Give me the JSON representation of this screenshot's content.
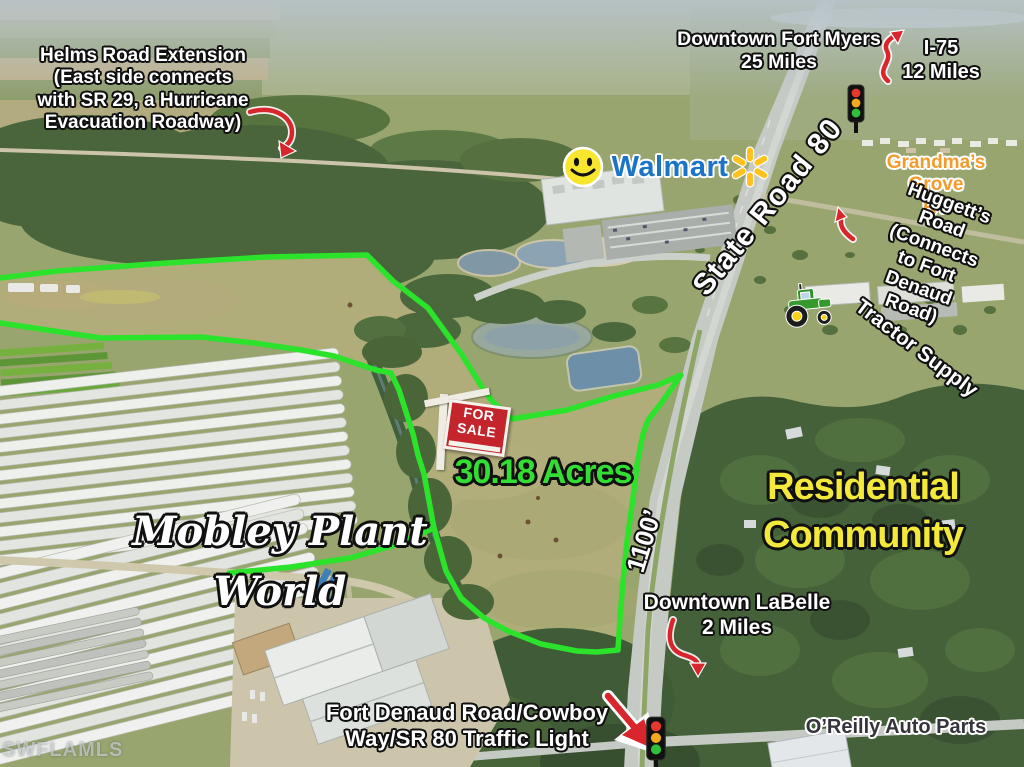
{
  "meta": {
    "type": "aerial-real-estate-listing-photo",
    "watermark": "SWFLAMLS"
  },
  "property": {
    "acreage": "30.18 Acres",
    "road_frontage": "1100’",
    "for_sale_sign": "FOR\nSALE",
    "boundary_color": "#2be32b"
  },
  "annotations": {
    "helms_road": "Helms Road Extension\n(East side connects\nwith SR 29, a Hurricane\nEvacuation Roadway)",
    "downtown_fort_myers": "Downtown Fort Myers\n25 Miles",
    "i75": "I-75\n12 Miles",
    "walmart": "Walmart",
    "state_road_80": "State Road 80",
    "grandmas_grove_rv": "Grandma’s Grove\nRV",
    "huggetts_road": "Huggett’s Road\n(Connects to Fort\nDenaud Road)",
    "tractor_supply": "Tractor Supply",
    "mobley_plant_world": "Mobley Plant\nWorld",
    "residential_community": "Residential\nCommunity",
    "downtown_labelle": "Downtown LaBelle\n2 Miles",
    "fort_denaud_traffic_light": "Fort Denaud Road/Cowboy\nWay/SR 80 Traffic Light",
    "oreilly": "O’Reilly Auto Parts"
  },
  "icons": {
    "smiley": "smiley-face-icon",
    "walmart_spark": "walmart-spark-icon",
    "traffic_light_top": "traffic-light-icon",
    "traffic_light_bottom": "traffic-light-icon",
    "tractor": "tractor-icon",
    "for_sale_sign": "for-sale-sign",
    "red_arrows": "curved-red-arrow"
  },
  "colors": {
    "boundary_green": "#2be32b",
    "acreage_text": "#33dd33",
    "residential_yellow": "#f2e93a",
    "grandmas_orange": "#f59b2e",
    "walmart_blue": "#1b74c6",
    "walmart_yellow": "#ffc220",
    "arrow_red": "#d8262c",
    "oreilly_text": "#34343a",
    "for_sale_red": "#c4242b"
  }
}
